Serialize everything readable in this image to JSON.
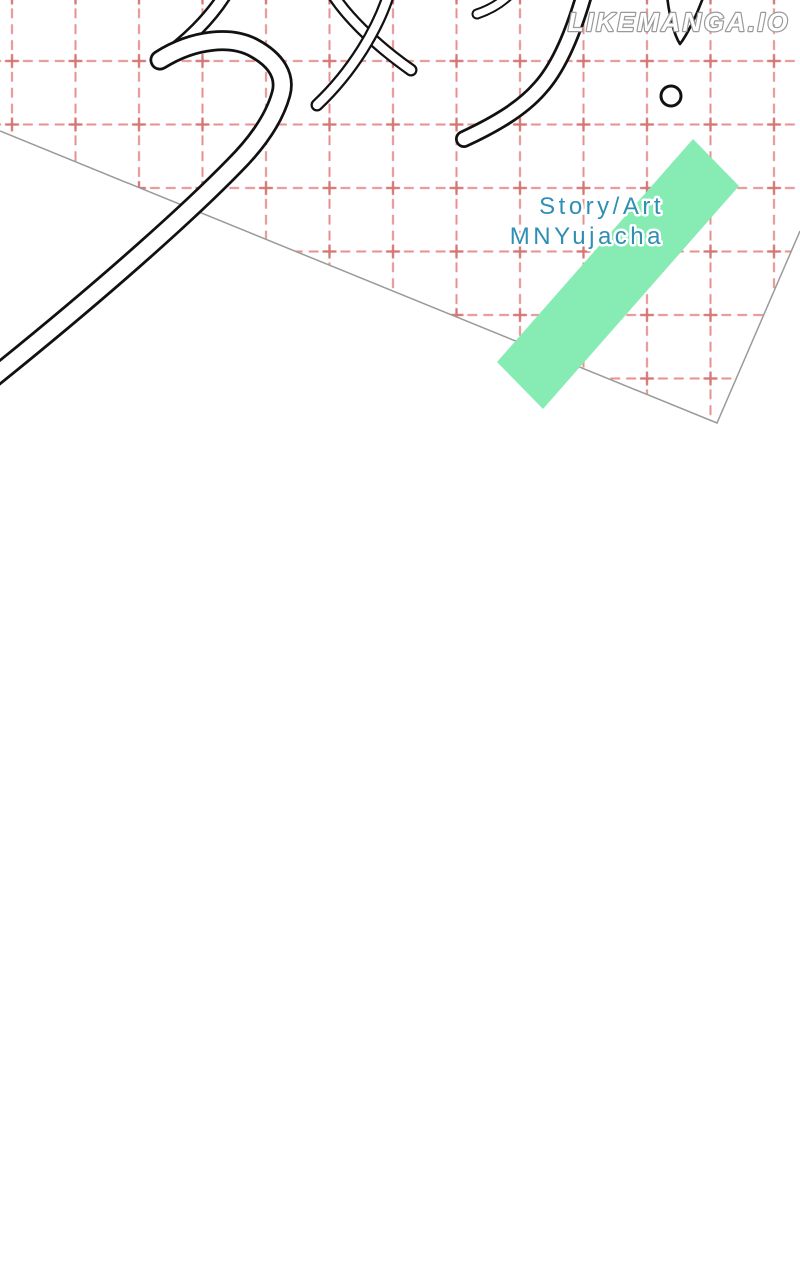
{
  "site": {
    "watermark": "LIKEMANGA.IO"
  },
  "credits": {
    "role": "Story/Art",
    "author": "MNYujacha"
  },
  "artwork": {
    "description": "webtoon title page: hand-drawn katakana calligraphy strokes and exclamation mark over a tilted sheet of pink graph paper with a mint diagonal ribbon",
    "elements": [
      "graph-paper-sheet",
      "pink-dashed-grid",
      "green-ribbon",
      "title-calligraphy-strokes",
      "exclamation-mark"
    ]
  },
  "colors": {
    "page_bg": "#ffffff",
    "grid_pink": "#e69090",
    "grid_cross": "#d57575",
    "paper_edge": "#9a9a9a",
    "ribbon_green": "#87ecb4",
    "credit_blue": "#2f8fb3",
    "ink_black": "#111111",
    "watermark_fill": "#ffffff",
    "watermark_outline": "#999999"
  }
}
